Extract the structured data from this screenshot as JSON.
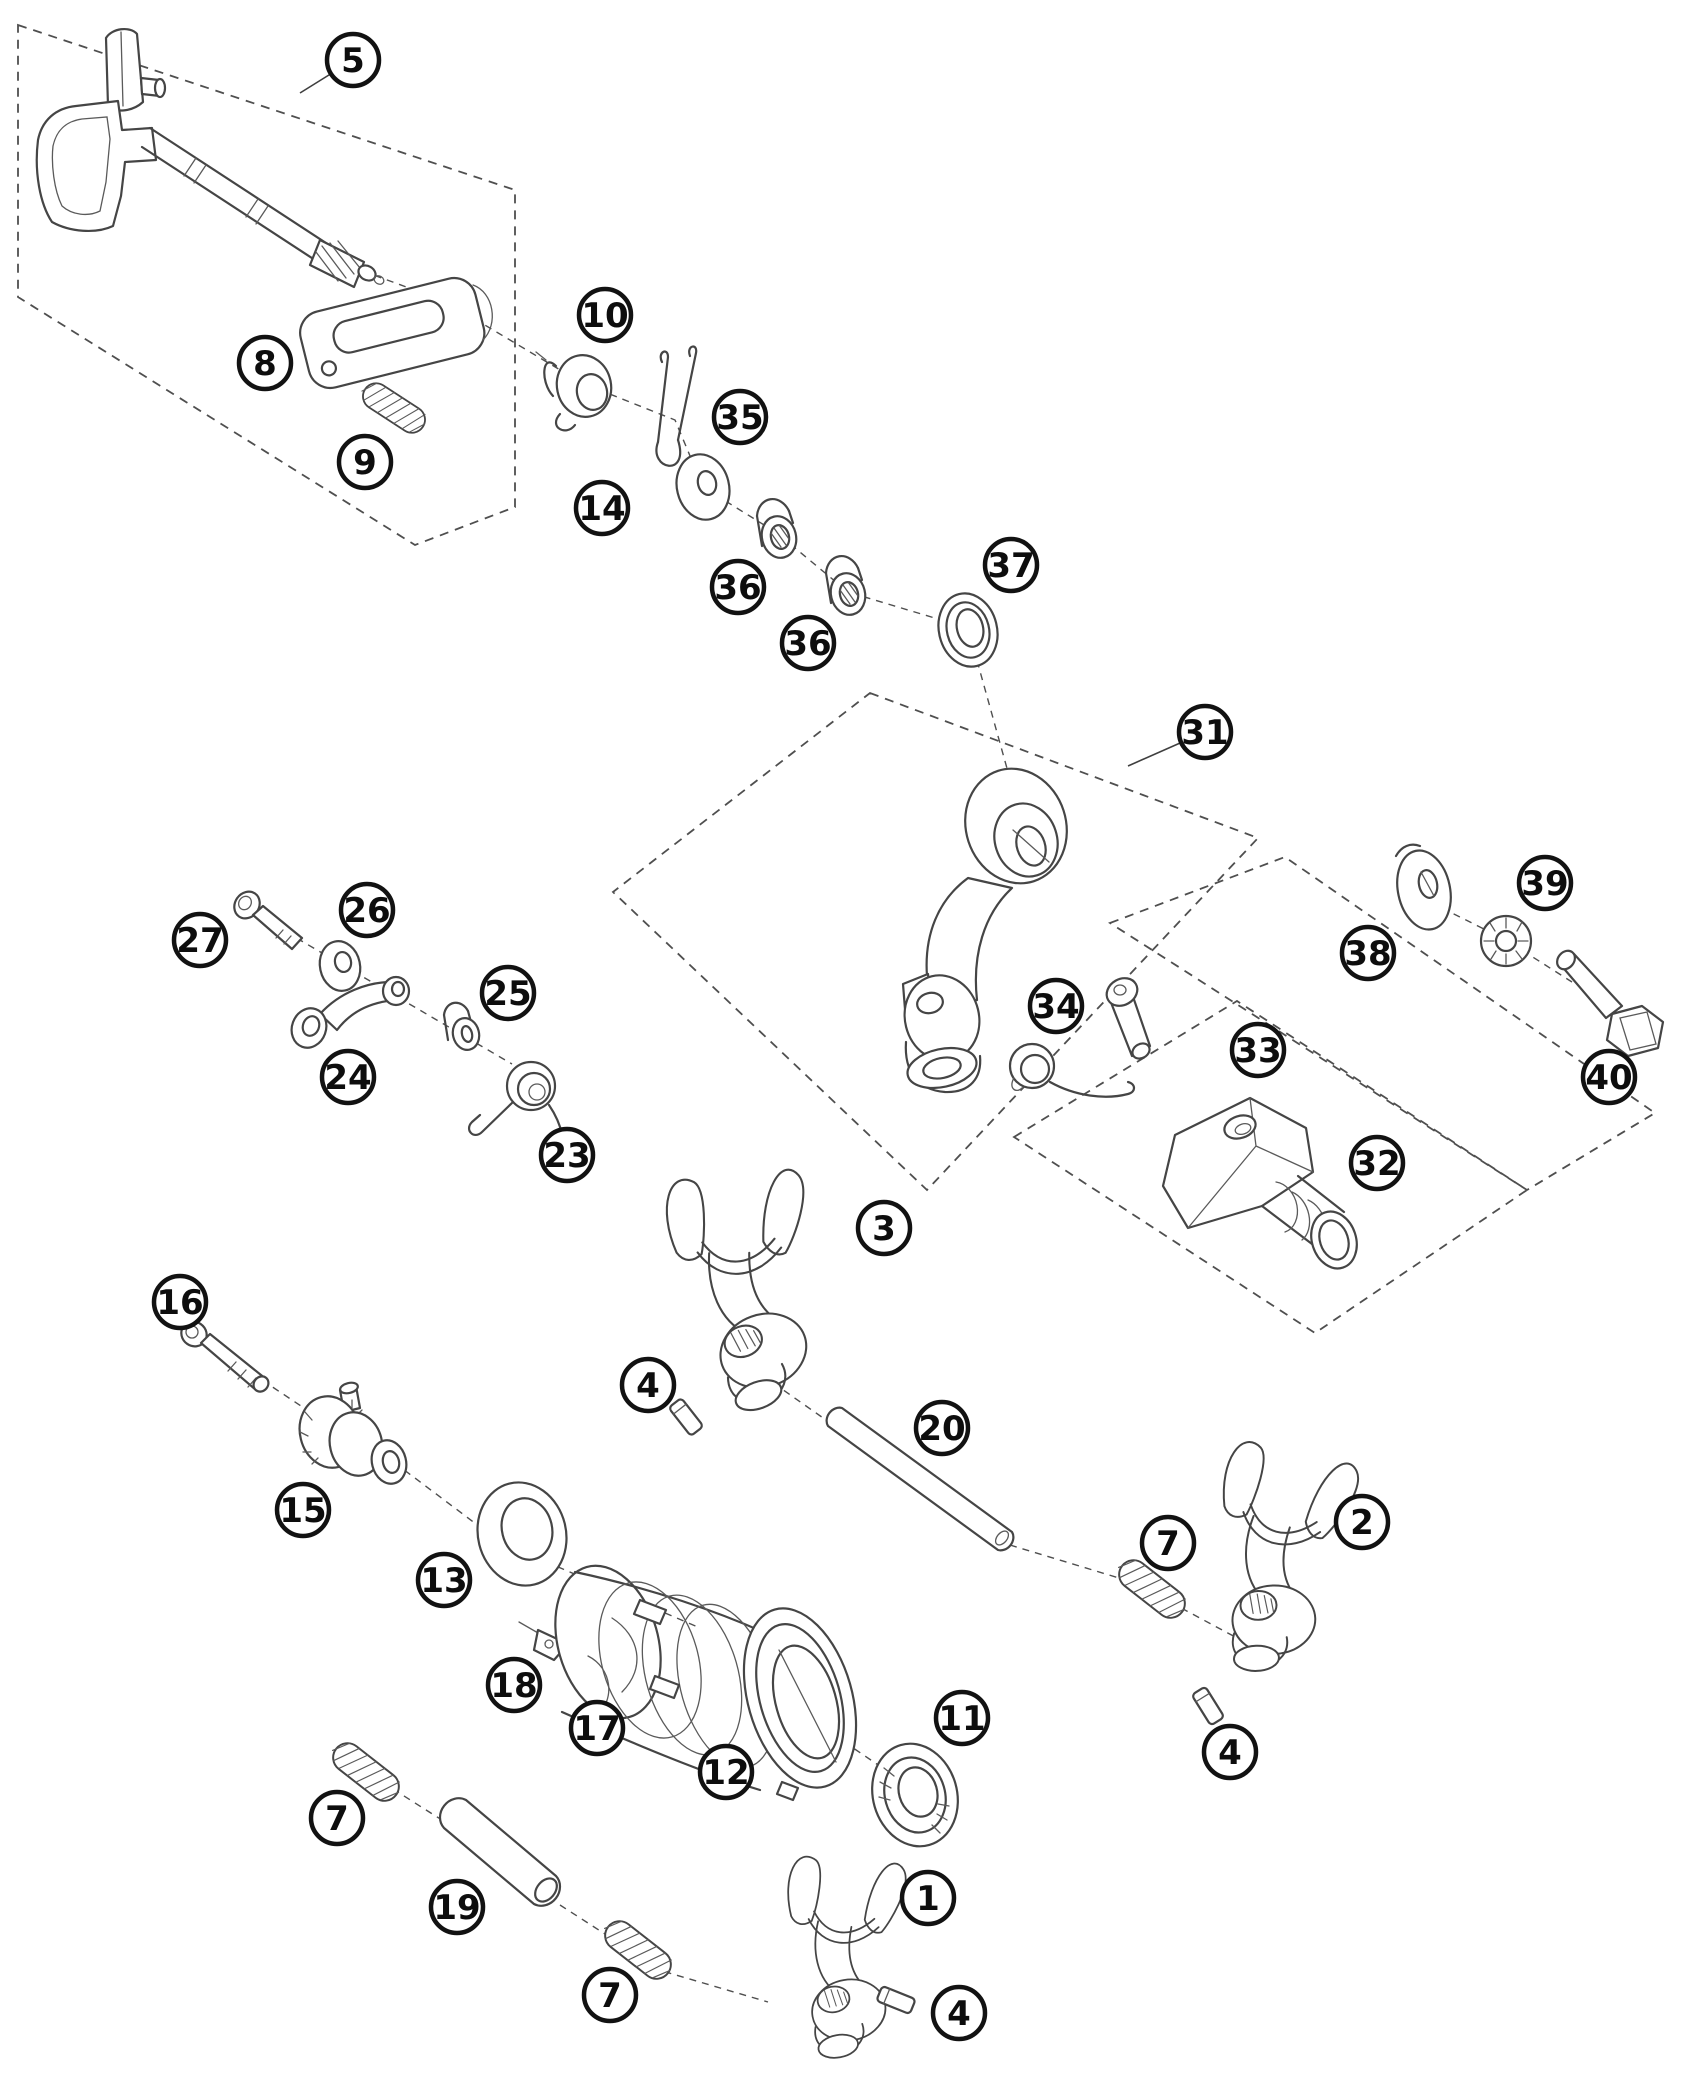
{
  "diagram": {
    "figure_type": "exploded-parts-diagram",
    "canvas": {
      "width": 1700,
      "height": 2079
    },
    "style": {
      "background": "#ffffff",
      "border_color": "#c8c8c8",
      "line_color": "#454545",
      "dash_color": "#4f4f4f",
      "leader_color": "#3f3f3f",
      "callout_stroke": "#121212",
      "callout_fill": "#ffffff",
      "callout_text_color": "#0d0d0d",
      "callout_radius": 26
    },
    "callouts": [
      {
        "label": "5",
        "x": 353,
        "y": 60,
        "tx": 300,
        "ty": 93
      },
      {
        "label": "8",
        "x": 265,
        "y": 363
      },
      {
        "label": "9",
        "x": 365,
        "y": 462
      },
      {
        "label": "10",
        "x": 605,
        "y": 315
      },
      {
        "label": "14",
        "x": 602,
        "y": 508
      },
      {
        "label": "35",
        "x": 740,
        "y": 417
      },
      {
        "label": "36",
        "x": 738,
        "y": 587
      },
      {
        "label": "36",
        "x": 808,
        "y": 643
      },
      {
        "label": "37",
        "x": 1011,
        "y": 565
      },
      {
        "label": "31",
        "x": 1205,
        "y": 732,
        "tx": 1128,
        "ty": 766
      },
      {
        "label": "27",
        "x": 200,
        "y": 940
      },
      {
        "label": "26",
        "x": 367,
        "y": 910
      },
      {
        "label": "25",
        "x": 508,
        "y": 993
      },
      {
        "label": "24",
        "x": 348,
        "y": 1077
      },
      {
        "label": "23",
        "x": 567,
        "y": 1155
      },
      {
        "label": "38",
        "x": 1368,
        "y": 953
      },
      {
        "label": "39",
        "x": 1545,
        "y": 883
      },
      {
        "label": "40",
        "x": 1609,
        "y": 1077
      },
      {
        "label": "33",
        "x": 1258,
        "y": 1050
      },
      {
        "label": "34",
        "x": 1056,
        "y": 1006
      },
      {
        "label": "32",
        "x": 1377,
        "y": 1163
      },
      {
        "label": "3",
        "x": 884,
        "y": 1228
      },
      {
        "label": "4",
        "x": 648,
        "y": 1385
      },
      {
        "label": "20",
        "x": 942,
        "y": 1428
      },
      {
        "label": "16",
        "x": 180,
        "y": 1302
      },
      {
        "label": "15",
        "x": 303,
        "y": 1510
      },
      {
        "label": "13",
        "x": 444,
        "y": 1580
      },
      {
        "label": "18",
        "x": 514,
        "y": 1685
      },
      {
        "label": "17",
        "x": 597,
        "y": 1728
      },
      {
        "label": "12",
        "x": 726,
        "y": 1772
      },
      {
        "label": "11",
        "x": 962,
        "y": 1718
      },
      {
        "label": "2",
        "x": 1362,
        "y": 1522
      },
      {
        "label": "7",
        "x": 1168,
        "y": 1543
      },
      {
        "label": "4",
        "x": 1230,
        "y": 1752
      },
      {
        "label": "7",
        "x": 337,
        "y": 1818
      },
      {
        "label": "19",
        "x": 457,
        "y": 1907
      },
      {
        "label": "7",
        "x": 610,
        "y": 1995
      },
      {
        "label": "1",
        "x": 928,
        "y": 1898
      },
      {
        "label": "4",
        "x": 959,
        "y": 2013
      }
    ],
    "group_boxes": [
      {
        "name": "group-box-shift-shaft-5",
        "points": "18,25 515,190 515,507 415,545 18,297"
      },
      {
        "name": "group-box-shift-lever-31",
        "points": "870,693 1258,838 927,1190 613,892"
      },
      {
        "name": "group-box-washers-38-40",
        "points": "1110,923 1285,857 1655,1113 1527,1190"
      },
      {
        "name": "group-box-shift-rubber-32",
        "points": "1014,1137 1237,1001 1527,1190 1315,1333"
      }
    ],
    "axis_lines": [
      "463,312 582,383 675,420 703,487 777,533 848,592 968,628 1008,772",
      "338,262 420,292",
      "252,912 512,1064",
      "208,1344 310,1412 375,1448 500,1542 700,1628",
      "790,1705 912,1788",
      "382,1782 445,1822",
      "560,1905 622,1945",
      "652,1968 768,2002",
      "752,1368 826,1420",
      "1010,1545 1152,1588",
      "1170,1602 1252,1646",
      "1442,908 1506,940 1572,982"
    ]
  }
}
